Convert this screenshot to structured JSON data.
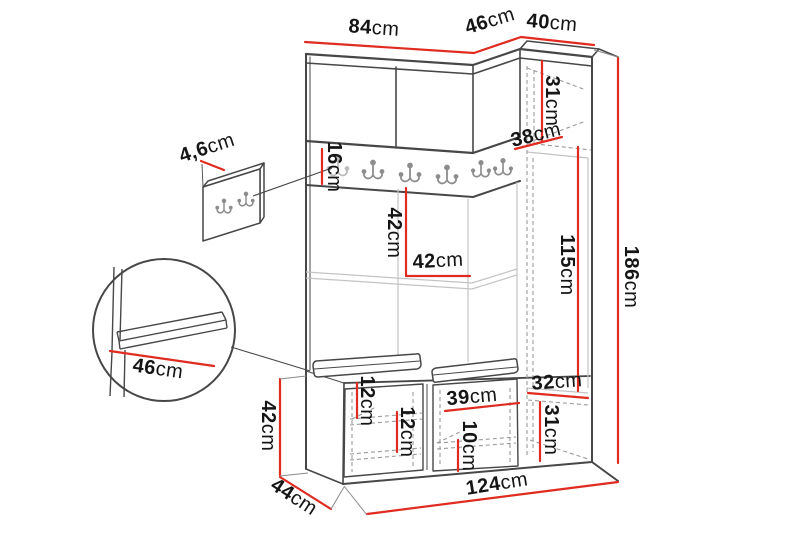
{
  "diagram_type": "furniture-dimension-diagram",
  "colors": {
    "dimension_line": "#e02b20",
    "outline": "#474747",
    "light_line": "#c3c3c3",
    "hidden_line": "#9a9a9a",
    "hook": "#8d8d8d",
    "hook_faint": "#bdbdbd",
    "label_text": "#151515",
    "background": "#ffffff"
  },
  "dimensions": {
    "top_left_width": {
      "value": "84",
      "unit": "cm"
    },
    "top_corner_width": {
      "value": "46",
      "unit": "cm"
    },
    "top_right_width": {
      "value": "40",
      "unit": "cm"
    },
    "right_top_section_height": {
      "value": "31",
      "unit": "cm"
    },
    "right_top_depth": {
      "value": "38",
      "unit": "cm"
    },
    "right_door_height": {
      "value": "115",
      "unit": "cm"
    },
    "total_height": {
      "value": "186",
      "unit": "cm"
    },
    "wall_panel_thickness": {
      "value": "4,6",
      "unit": "cm"
    },
    "hook_rail_height": {
      "value": "16",
      "unit": "cm"
    },
    "niche_height": {
      "value": "42",
      "unit": "cm"
    },
    "niche_width": {
      "value": "42",
      "unit": "cm"
    },
    "seat_detail_depth": {
      "value": "46",
      "unit": "cm"
    },
    "bench_height": {
      "value": "42",
      "unit": "cm"
    },
    "bench_depth": {
      "value": "44",
      "unit": "cm"
    },
    "bench_left_gap_top": {
      "value": "12",
      "unit": "cm"
    },
    "bench_left_gap_bottom": {
      "value": "12",
      "unit": "cm"
    },
    "bench_right_width": {
      "value": "39",
      "unit": "cm"
    },
    "bench_right_gap": {
      "value": "10",
      "unit": "cm"
    },
    "right_bottom_width": {
      "value": "32",
      "unit": "cm"
    },
    "right_bottom_height": {
      "value": "31",
      "unit": "cm"
    },
    "total_width": {
      "value": "124",
      "unit": "cm"
    }
  }
}
